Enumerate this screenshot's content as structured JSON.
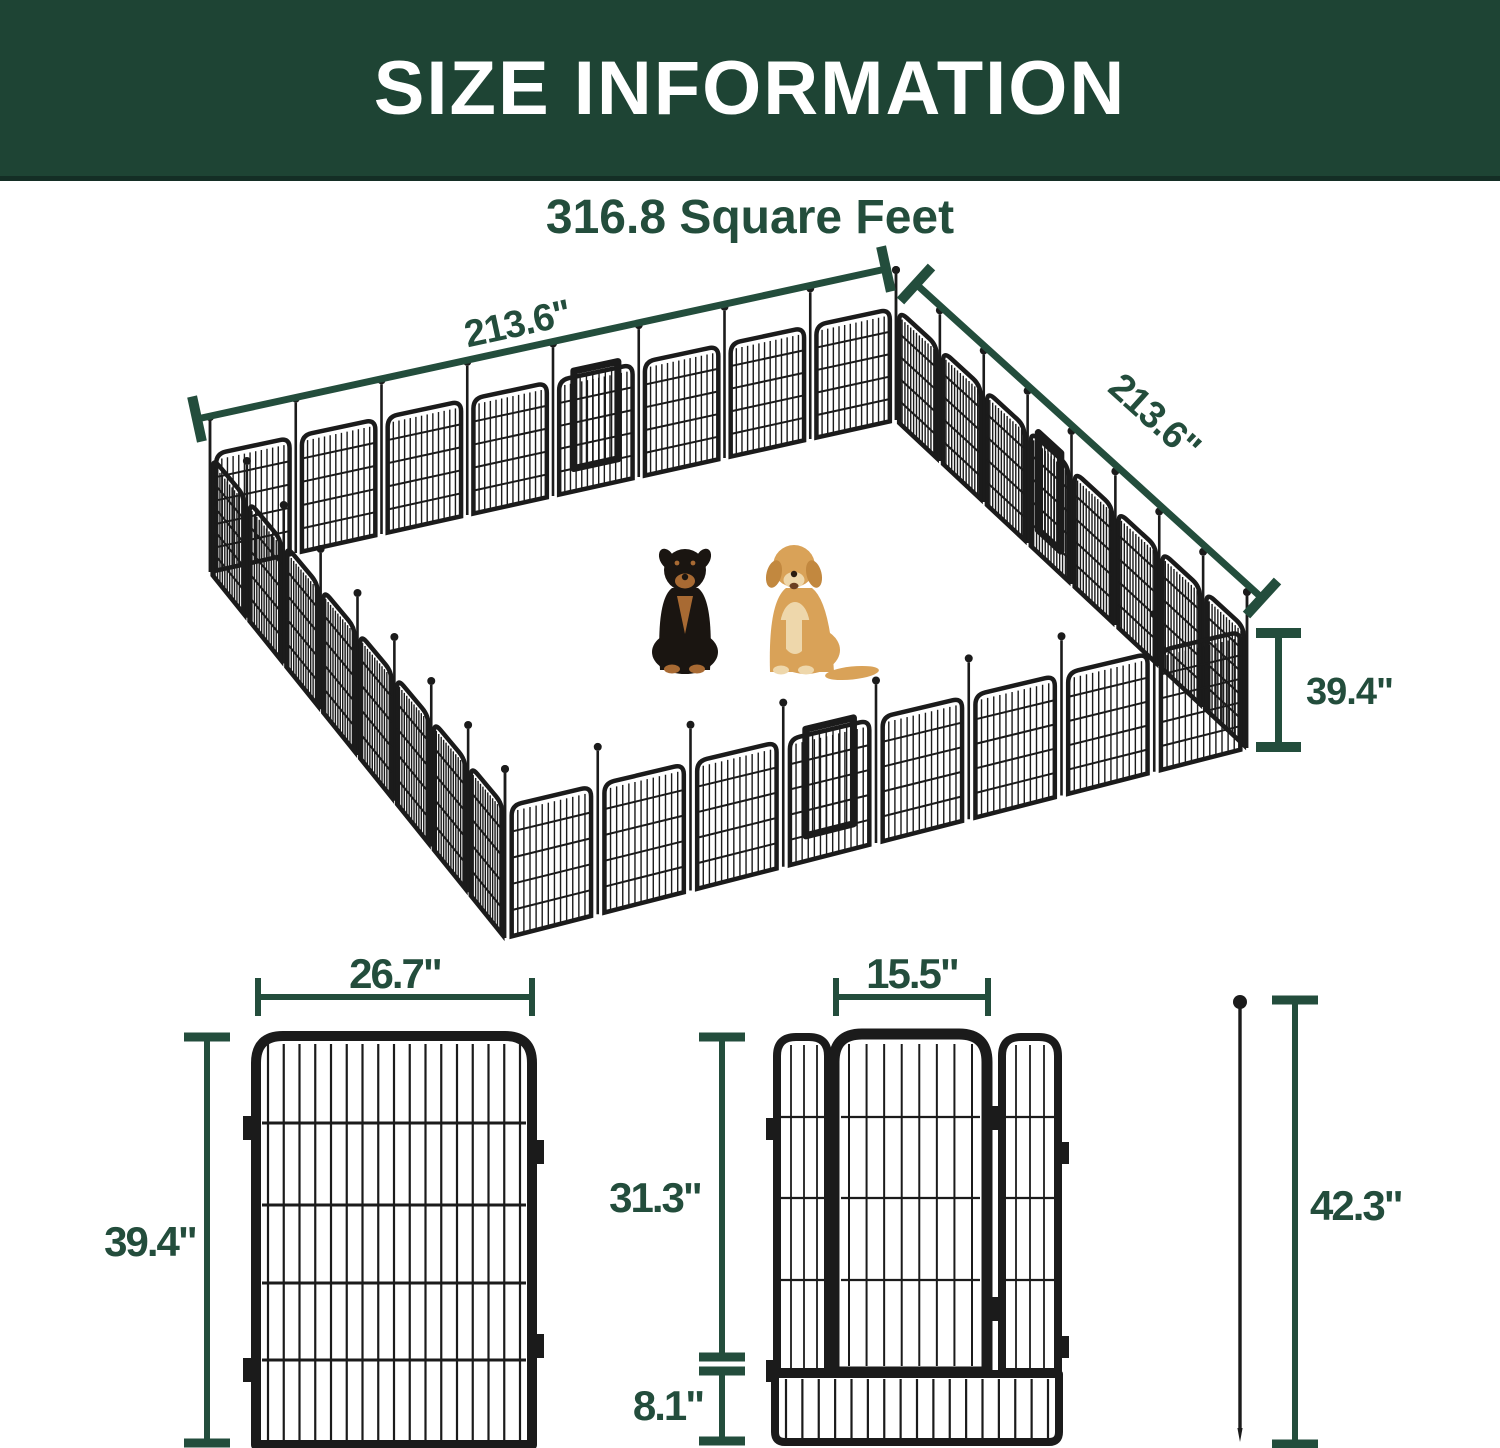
{
  "header": {
    "title": "SIZE INFORMATION"
  },
  "area": {
    "title": "316.8 Square Feet"
  },
  "pen": {
    "width_label": "213.6\"",
    "depth_label": "213.6\"",
    "height_label": "39.4\"",
    "panels_per_side": 8,
    "contents": [
      "rottweiler",
      "golden-retriever"
    ]
  },
  "panel_detail": {
    "width_label": "26.7\"",
    "height_label": "39.4\""
  },
  "gate_detail": {
    "width_label": "15.5\"",
    "height_label": "31.3\"",
    "bottom_height_label": "8.1\""
  },
  "stake_detail": {
    "height_label": "42.3\""
  },
  "colors": {
    "header_green": "#1e4434",
    "header_green_dark": "#142e25",
    "accent_green": "#234d3c",
    "fence_black": "#1b1b1b",
    "rottweiler_black": "#1a1511",
    "rottweiler_tan": "#a86a33",
    "golden_coat": "#d9a258",
    "golden_light": "#eed7ab",
    "golden_dark": "#c2883f"
  }
}
